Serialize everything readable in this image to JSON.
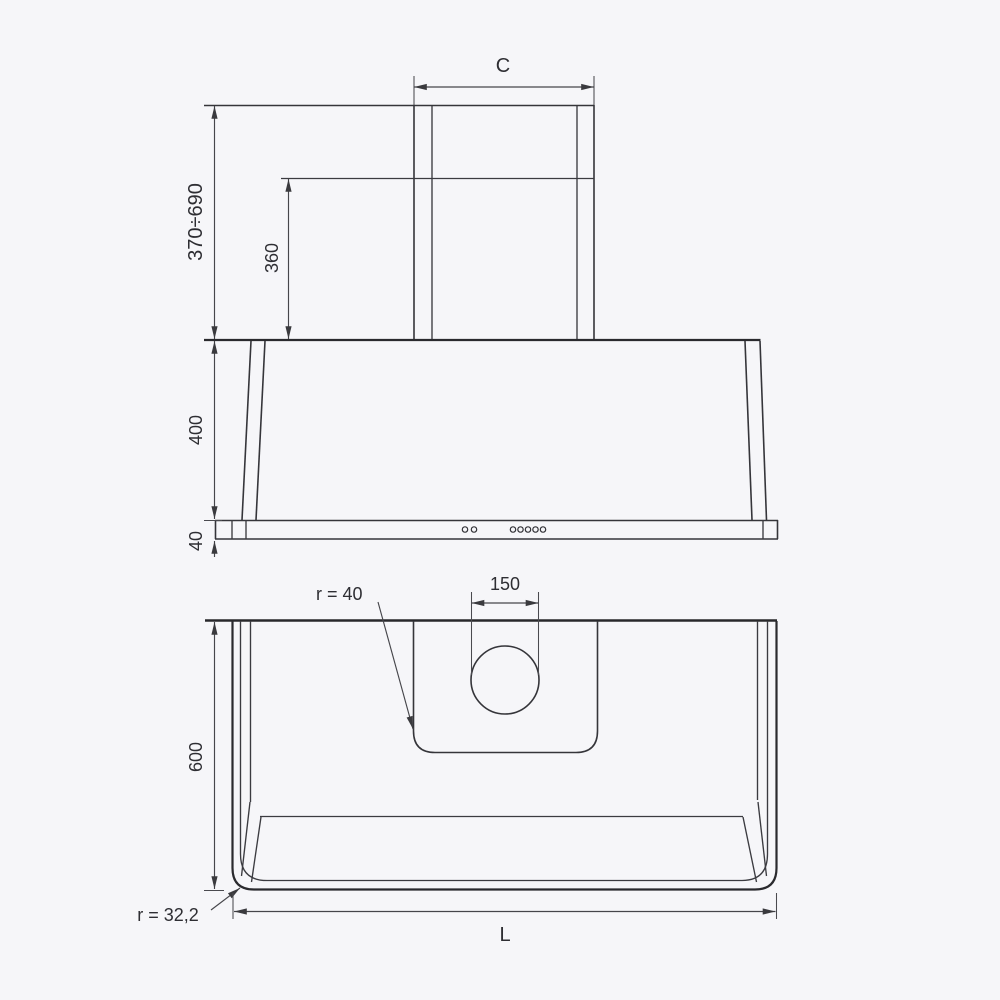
{
  "drawing": {
    "type": "range-hood dimensional drawing",
    "colors": {
      "background": "#f6f6f9",
      "outline": "#2a2a2e",
      "dimension": "#46464b",
      "text": "#2e2e33"
    },
    "front_view": {
      "chimney_width_label": "C",
      "chimney_height_range": "370÷690",
      "lower_chimney_height": "360",
      "body_height": "400",
      "base_height": "40"
    },
    "plan_view": {
      "depth": "600",
      "duct_hole_width": "150",
      "recess_corner_radius": "r = 40",
      "body_corner_radius": "r = 32,2",
      "overall_width_label": "L"
    }
  }
}
